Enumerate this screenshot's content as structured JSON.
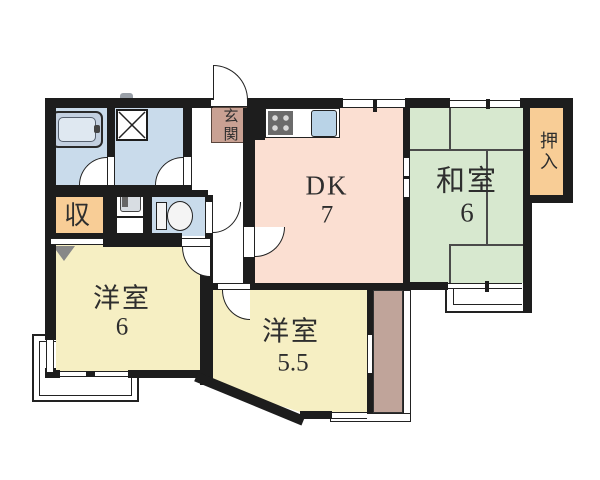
{
  "meta": {
    "type": "apartment-floor-plan"
  },
  "rooms": {
    "dk": {
      "label": "DK",
      "size": "7"
    },
    "washitsu": {
      "label": "和室",
      "size": "6"
    },
    "youshitsu_main": {
      "label": "洋室",
      "size": "6"
    },
    "youshitsu_second": {
      "label": "洋室",
      "size": "5.5"
    },
    "storage": {
      "label": "収"
    },
    "oshiire": {
      "label": "押入"
    },
    "genkan": {
      "label": "玄関"
    }
  },
  "colors": {
    "wall": "#1d1d1d",
    "dk_pink": "#fbdfd2",
    "washitsu_green": "#d7e8cf",
    "youshitsu_yellow": "#f6efc3",
    "storage_orange": "#f8cd96",
    "genkan_brown": "#c9a193",
    "balcony_mauve": "#c0a49a",
    "wet_room_blue": "#c9dbeb",
    "kitchen_sink_blue": "#b9d3e7"
  },
  "fixtures": [
    "bathtub",
    "washing-machine",
    "wash-basin",
    "toilet",
    "kitchen-stove",
    "kitchen-sink"
  ]
}
